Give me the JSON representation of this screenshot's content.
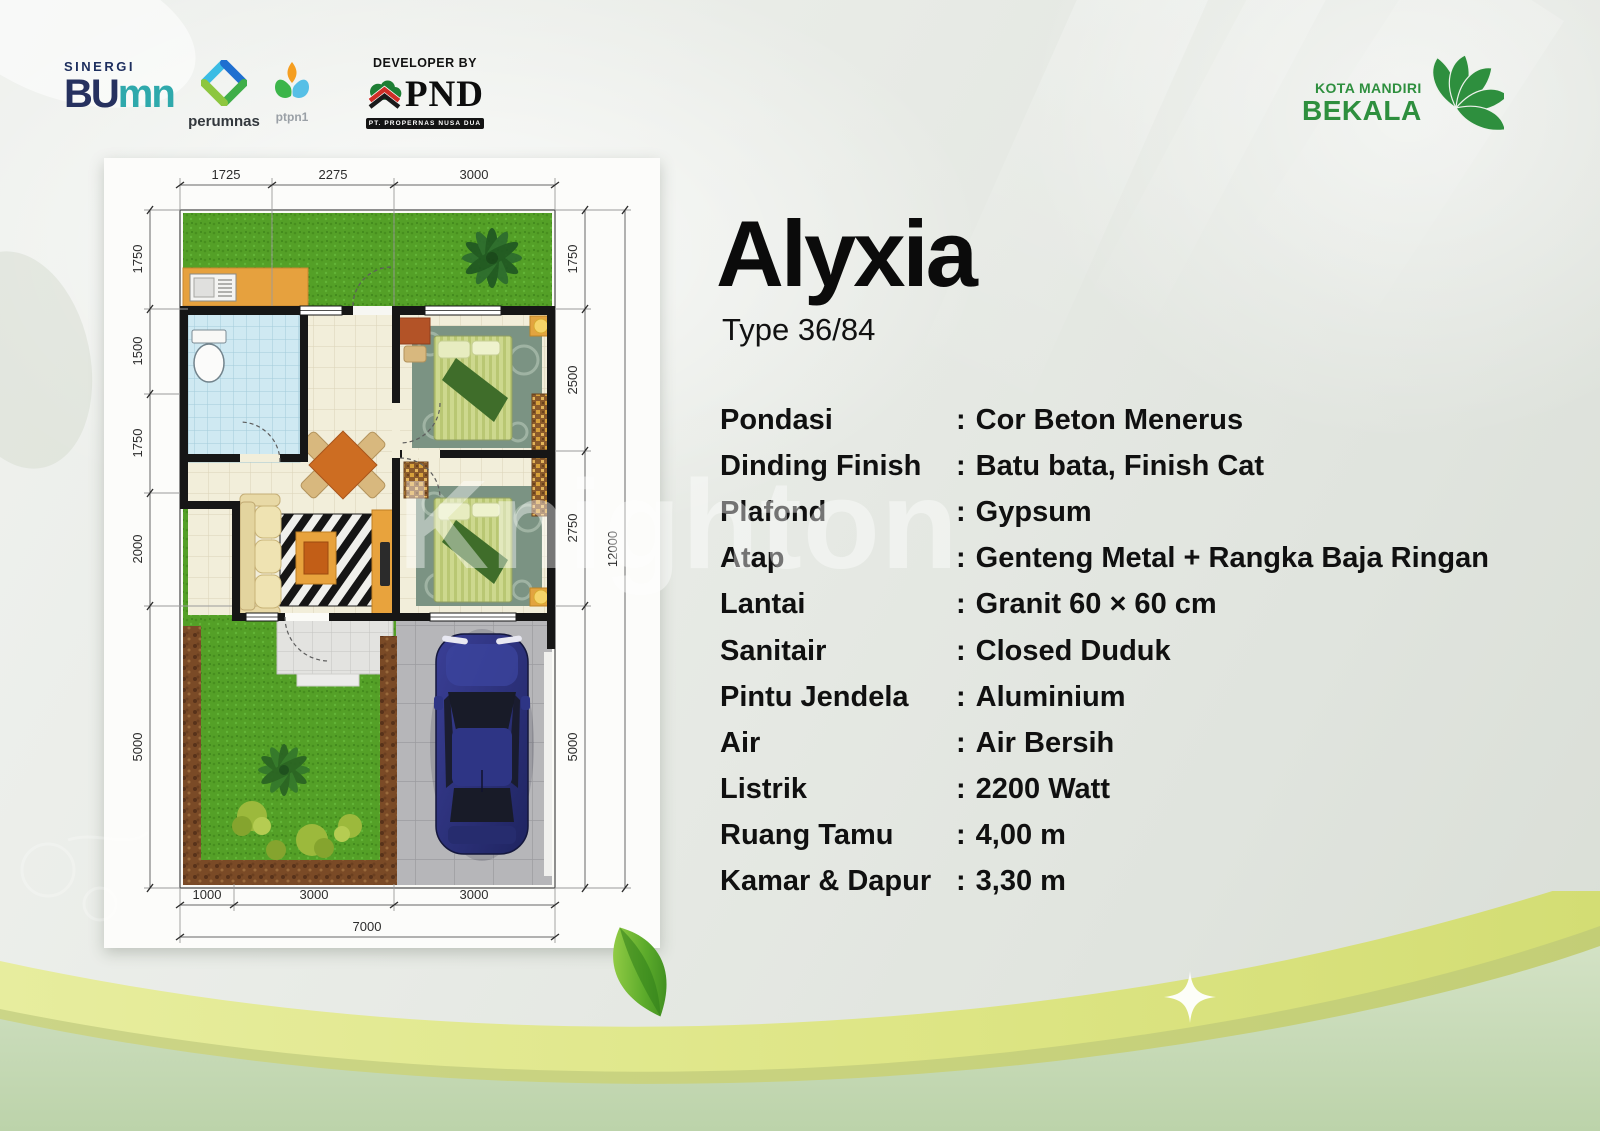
{
  "header": {
    "sinergi": {
      "caption": "SINERGI",
      "bu": "BU",
      "mn": "mn"
    },
    "perumnas": {
      "label": "perumnas"
    },
    "ptpn1": {
      "label": "ptpn1"
    },
    "developer": {
      "caption": "DEVELOPER BY",
      "name": "PND",
      "subtitle": "PT. PROPERNAS NUSA DUA"
    },
    "bekala": {
      "line1": "KOTA MANDIRI",
      "line2": "BEKALA"
    }
  },
  "content": {
    "title": "Alyxia",
    "subtitle": "Type 36/84"
  },
  "specs": {
    "colon": ":",
    "rows": [
      {
        "label": "Pondasi",
        "value": "Cor Beton Menerus"
      },
      {
        "label": "Dinding Finish",
        "value": "Batu bata, Finish Cat"
      },
      {
        "label": "Plafond",
        "value": "Gypsum"
      },
      {
        "label": "Atap",
        "value": "Genteng Metal + Rangka Baja Ringan"
      },
      {
        "label": "Lantai",
        "value": "Granit 60 × 60 cm"
      },
      {
        "label": "Sanitair",
        "value": "Closed Duduk"
      },
      {
        "label": "Pintu Jendela",
        "value": "Aluminium"
      },
      {
        "label": "Air",
        "value": "Air Bersih"
      },
      {
        "label": "Listrik",
        "value": "2200 Watt"
      },
      {
        "label": "Ruang Tamu",
        "value": "4,00 m"
      },
      {
        "label": "Kamar & Dapur",
        "value": "3,30 m"
      }
    ]
  },
  "floorplan": {
    "dims_top": [
      "1725",
      "2275",
      "3000"
    ],
    "dims_left": [
      "1750",
      "1500",
      "1750",
      "2000",
      "5000"
    ],
    "dims_right": [
      "1750",
      "2500",
      "2750",
      "5000"
    ],
    "dim_right_total": "12000",
    "dims_bottom": [
      "1000",
      "3000",
      "3000"
    ],
    "dim_bottom_total": "7000"
  },
  "watermark": "Knighton",
  "colors": {
    "accent_green": "#2e8f3e",
    "band_yellow": "#dde58b",
    "band_sage": "#c8dab8",
    "car_blue": "#2a2f7a"
  }
}
